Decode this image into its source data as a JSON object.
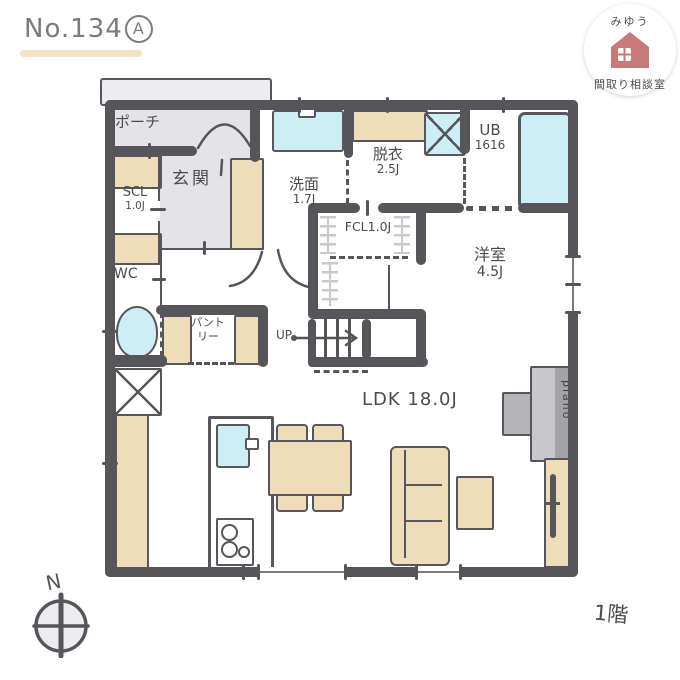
{
  "title": {
    "number": "No.134",
    "variant": "A"
  },
  "logo": {
    "top_text": "みゆう",
    "bottom_text": "間取り相談室"
  },
  "floor_plan": {
    "floor_label": "1階",
    "compass_label": "N",
    "rooms": {
      "porch": {
        "label": "ポーチ"
      },
      "entrance": {
        "label": "玄関"
      },
      "shoe_closet": {
        "label": "SCL",
        "size": "1.0J"
      },
      "washroom": {
        "label": "洗面",
        "size": "1.7J"
      },
      "dressing_room": {
        "label": "脱衣",
        "size": "2.5J"
      },
      "unit_bath": {
        "label": "UB",
        "size": "1616"
      },
      "family_closet": {
        "label": "FCL1.0J"
      },
      "western_room": {
        "label": "洋室",
        "size": "4.5J"
      },
      "toilet_room": {
        "label": "WC"
      },
      "pantry": {
        "label": "パントリー"
      },
      "ldk": {
        "label": "LDK 18.0J"
      },
      "stairs": {
        "label": "UP"
      }
    },
    "furniture": {
      "piano": "piano"
    }
  },
  "colors": {
    "wall": "#56565a",
    "floor_gray": "#e4e4e7",
    "wood_tan": "#eedcba",
    "water_blue": "#cdeef6",
    "accent_pink": "#c87a7a",
    "underline_tan": "#f3e2c3"
  }
}
